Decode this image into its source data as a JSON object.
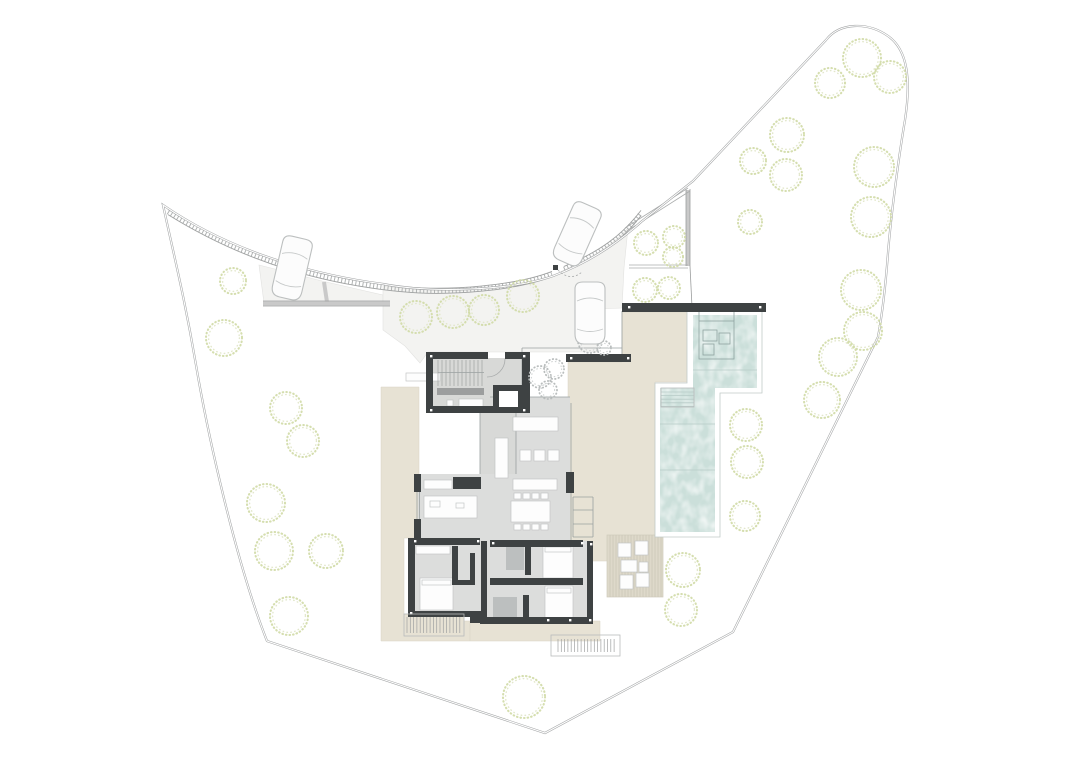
{
  "meta": {
    "title": "Architectural site plan — villa ground floor with pool and gardens",
    "visible_text": "none — drawing only",
    "canvas": {
      "width": 1080,
      "height": 764
    }
  },
  "palette": {
    "background": "#ffffff",
    "boundary_line": "#a2a4a5",
    "driveway": "#f3f3f1",
    "terrace_beige": "#e7e2d4",
    "deck_platform": "#ded9ca",
    "pool_water": "#cbdfda",
    "interior_floor": "#dcdddc",
    "wall_dark": "#3e4243",
    "tree_green": "#d0daa6",
    "tree_gray": "#b9bdbd",
    "shower_tile": "#b6baba",
    "car_outline": "#bcbfbf"
  },
  "paths": {
    "plot_boundary": "M163,205 C175,260 185,300 196,365 C207,430 235,560 267,641 L545,733 L733,632 L878,337 C883,310 886,280 888,253 C891,215 899,155 905,120 C911,80 908,50 888,36 C868,22 840,22 826,40 L693,181 L641,222 C610,250 580,266 553,276 C510,291 430,293 383,284 C330,277 240,258 163,205 Z",
    "curb_left": "M168,212 C250,263 330,282 400,289 C450,294 516,288 552,274",
    "curb_right": "M564,269 C600,254 622,238 641,213",
    "driveway_strip": "M259,265 L322,281 L383,295 L383,303 L264,303 Z",
    "driveway_court": "M383,286 C430,292 505,291 552,277 L564,270 C592,258 614,244 628,228 L624,268 L622,308 L598,309 L598,352 L428,352 L420,363 L405,346 L383,330 Z",
    "deck_ne": "M622,312 L688,312 L688,382 L655,382 L655,561 L568,561 L568,362 L622,362 Z",
    "terrace_west": "M381,387 L419,387 L419,538 L404,538 L404,614 L464,614 L464,621 L470,621 L470,641 L381,641 Z",
    "terrace_south": "M470,621 L600,621 L600,641 L470,641 Z",
    "pool_coping": "M687,311 L762,311 L762,393 L720,393 L720,537 L655,537 L655,383 L687,383 Z",
    "pool_water": "M693,315 L757,315 L757,388 L715,388 L715,532 L660,532 L660,388 L693,388 Z",
    "floor_living": "M490,397 L570,397 L570,541 L418,541 L418,474 L490,474 Z",
    "floor_bedrooms": "M408,541 L593,541 L593,621 L470,621 L470,614 L408,614 Z",
    "door_arc": "M505,359 A18,18 0 0 1 487,377",
    "gate_arc": "M558,270 Q570,282 582,272"
  },
  "retaining_walls": {
    "bands": [
      [
        263,
        303.5,
        390,
        303.5
      ],
      [
        324,
        282,
        327,
        302
      ],
      [
        688,
        190,
        688,
        266
      ]
    ],
    "edges": [
      [
        263,
        301,
        390,
        301
      ],
      [
        263,
        306,
        390,
        306
      ],
      [
        686,
        189,
        686,
        266
      ],
      [
        690,
        189,
        690,
        266
      ],
      [
        690,
        266,
        692,
        307
      ]
    ],
    "hedge_lines": [
      [
        625,
        228,
        688,
        188
      ],
      [
        627,
        231,
        690,
        191
      ],
      [
        629,
        265,
        688,
        265
      ],
      [
        629,
        268,
        688,
        268
      ]
    ]
  },
  "walls": [
    [
      622,
      303,
      144,
      9
    ],
    [
      566,
      354,
      65,
      8
    ],
    [
      426,
      352,
      62,
      7
    ],
    [
      505,
      352,
      24,
      7
    ],
    [
      426,
      352,
      7,
      61
    ],
    [
      426,
      406,
      104,
      7
    ],
    [
      522,
      352,
      8,
      61
    ],
    [
      493,
      385,
      31,
      28
    ],
    [
      414,
      474,
      7,
      18
    ],
    [
      414,
      519,
      7,
      22
    ],
    [
      453,
      477,
      28,
      12
    ],
    [
      566,
      472,
      8,
      21
    ],
    [
      408,
      538,
      7,
      76
    ],
    [
      412,
      538,
      68,
      7
    ],
    [
      490,
      540,
      93,
      7
    ],
    [
      408,
      611,
      63,
      6
    ],
    [
      470,
      611,
      11,
      12
    ],
    [
      480,
      617,
      113,
      7
    ],
    [
      587,
      541,
      6,
      83
    ],
    [
      452,
      546,
      6,
      36
    ],
    [
      481,
      541,
      6,
      76
    ],
    [
      525,
      543,
      6,
      32
    ],
    [
      490,
      578,
      93,
      7
    ],
    [
      523,
      595,
      6,
      26
    ],
    [
      470,
      553,
      5,
      30
    ],
    [
      452,
      580,
      23,
      5
    ]
  ],
  "gray_walls": [
    [
      437,
      388,
      47,
      7
    ]
  ],
  "floors": [
    [
      432,
      358,
      90,
      49
    ],
    [
      480,
      407,
      36,
      67
    ]
  ],
  "shaft_inner": [
    499,
    391,
    19,
    16
  ],
  "furniture": [
    [
      513,
      417,
      45,
      14
    ],
    [
      520,
      450,
      11,
      11
    ],
    [
      534,
      450,
      11,
      11
    ],
    [
      548,
      450,
      11,
      11
    ],
    [
      495,
      438,
      13,
      40
    ],
    [
      513,
      479,
      44,
      11
    ],
    [
      511,
      501,
      39,
      21
    ],
    [
      514,
      493,
      7,
      6
    ],
    [
      523,
      493,
      7,
      6
    ],
    [
      532,
      493,
      7,
      6
    ],
    [
      541,
      493,
      7,
      6
    ],
    [
      514,
      524,
      7,
      6
    ],
    [
      523,
      524,
      7,
      6
    ],
    [
      532,
      524,
      7,
      6
    ],
    [
      541,
      524,
      7,
      6
    ],
    [
      424,
      496,
      53,
      22
    ],
    [
      424,
      480,
      28,
      9
    ],
    [
      430,
      501,
      10,
      6
    ],
    [
      456,
      503,
      8,
      5
    ],
    [
      416,
      546,
      34,
      8
    ],
    [
      420,
      578,
      33,
      32
    ],
    [
      422,
      580,
      29,
      5
    ],
    [
      543,
      545,
      30,
      33
    ],
    [
      545,
      547,
      26,
      5
    ],
    [
      545,
      586,
      28,
      32
    ],
    [
      547,
      588,
      24,
      5
    ],
    [
      459,
      399,
      24,
      8
    ],
    [
      447,
      400,
      6,
      6
    ],
    [
      618,
      543,
      13,
      14
    ],
    [
      635,
      541,
      13,
      14
    ],
    [
      620,
      575,
      13,
      14
    ],
    [
      636,
      573,
      13,
      14
    ],
    [
      621,
      560,
      16,
      12
    ],
    [
      639,
      562,
      9,
      10
    ],
    [
      406,
      373,
      34,
      8
    ]
  ],
  "showers": [
    [
      506,
      545,
      18,
      25
    ],
    [
      493,
      597,
      24,
      23
    ]
  ],
  "white_dots": [
    [
      430,
      355
    ],
    [
      523,
      355
    ],
    [
      430,
      409
    ],
    [
      523,
      409
    ],
    [
      414,
      540
    ],
    [
      477,
      540
    ],
    [
      492,
      542
    ],
    [
      581,
      542
    ],
    [
      547,
      619
    ],
    [
      569,
      619
    ],
    [
      590,
      543
    ],
    [
      628,
      306
    ],
    [
      759,
      306
    ],
    [
      570,
      357
    ],
    [
      627,
      357
    ],
    [
      410,
      612
    ],
    [
      589,
      619
    ]
  ],
  "thin_lines": [
    [
      571,
      403,
      571,
      541
    ],
    [
      490,
      397,
      570,
      397
    ],
    [
      522,
      348,
      522,
      406
    ],
    [
      622,
      311,
      622,
      362
    ],
    [
      522,
      348,
      622,
      348
    ],
    [
      480,
      407,
      480,
      474
    ],
    [
      516,
      407,
      516,
      474
    ],
    [
      417,
      492,
      417,
      519
    ],
    [
      419.5,
      492,
      419.5,
      519
    ],
    [
      573,
      497,
      593,
      497
    ],
    [
      573,
      510,
      593,
      510
    ],
    [
      573,
      524,
      593,
      524
    ],
    [
      573,
      537,
      593,
      537
    ],
    [
      573,
      497,
      573,
      537
    ],
    [
      593,
      497,
      593,
      537
    ],
    [
      438,
      372.5,
      484,
      372.5,
      2,
      "#ffffff"
    ]
  ],
  "teal_lines": [
    [
      660,
      424,
      715,
      424
    ],
    [
      660,
      470,
      715,
      470
    ],
    [
      693,
      370,
      757,
      370
    ]
  ],
  "tread_sets": [
    {
      "x": 438,
      "y": 360,
      "h": 26,
      "n": 12,
      "step": 4
    }
  ],
  "stair_frames": [
    [
      551,
      635,
      69,
      21
    ],
    [
      404,
      614,
      60,
      22
    ],
    [
      661,
      388,
      33,
      19
    ]
  ],
  "hatch_stairs": [
    {
      "x": 558,
      "y": 639,
      "h": 13,
      "n": 18,
      "step": 3.3
    },
    {
      "x": 407,
      "y": 617,
      "h": 16,
      "n": 17,
      "step": 3.3
    }
  ],
  "pool_steps": {
    "x": 661,
    "y": 392,
    "w": 33,
    "n": 5,
    "step": 3.6
  },
  "platform": {
    "x": 607,
    "y": 535,
    "w": 56,
    "h": 62,
    "step": 3
  },
  "spa": {
    "outer": [
      699,
      321,
      35,
      38
    ],
    "inner": [
      [
        703,
        330,
        14,
        11
      ],
      [
        703,
        344,
        11,
        11
      ],
      [
        719,
        333,
        11,
        11
      ]
    ],
    "stems": [
      [
        699,
        311,
        699,
        321
      ],
      [
        734,
        311,
        734,
        321
      ]
    ]
  },
  "gate": {
    "post": [
      553,
      265,
      5,
      5
    ]
  },
  "trees": {
    "green": [
      [
        233,
        281,
        13
      ],
      [
        224,
        338,
        18
      ],
      [
        286,
        408,
        16
      ],
      [
        303,
        441,
        16
      ],
      [
        266,
        503,
        19
      ],
      [
        274,
        551,
        19
      ],
      [
        326,
        551,
        17
      ],
      [
        289,
        616,
        19
      ],
      [
        524,
        697,
        21
      ],
      [
        416,
        317,
        16
      ],
      [
        453,
        312,
        16
      ],
      [
        484,
        310,
        15
      ],
      [
        523,
        296,
        16
      ],
      [
        646,
        243,
        12
      ],
      [
        674,
        237,
        11
      ],
      [
        673,
        257,
        10
      ],
      [
        645,
        290,
        12
      ],
      [
        669,
        288,
        11
      ],
      [
        746,
        425,
        16
      ],
      [
        747,
        462,
        16
      ],
      [
        745,
        516,
        15
      ],
      [
        683,
        570,
        17
      ],
      [
        681,
        610,
        16
      ],
      [
        830,
        83,
        15
      ],
      [
        862,
        58,
        19
      ],
      [
        890,
        77,
        16
      ],
      [
        787,
        135,
        17
      ],
      [
        753,
        161,
        13
      ],
      [
        786,
        175,
        16
      ],
      [
        874,
        167,
        20
      ],
      [
        871,
        217,
        20
      ],
      [
        750,
        222,
        12
      ],
      [
        861,
        290,
        20
      ],
      [
        863,
        331,
        19
      ],
      [
        838,
        357,
        19
      ],
      [
        822,
        400,
        18
      ]
    ],
    "gray": [
      [
        540,
        377,
        11
      ],
      [
        554,
        369,
        10
      ],
      [
        548,
        390,
        9
      ],
      [
        590,
        341,
        12
      ],
      [
        604,
        348,
        7
      ]
    ]
  },
  "cars": [
    {
      "cx": 292,
      "cy": 268,
      "angle": 13
    },
    {
      "cx": 577,
      "cy": 234,
      "angle": 24
    },
    {
      "cx": 590,
      "cy": 313,
      "angle": 0
    }
  ]
}
